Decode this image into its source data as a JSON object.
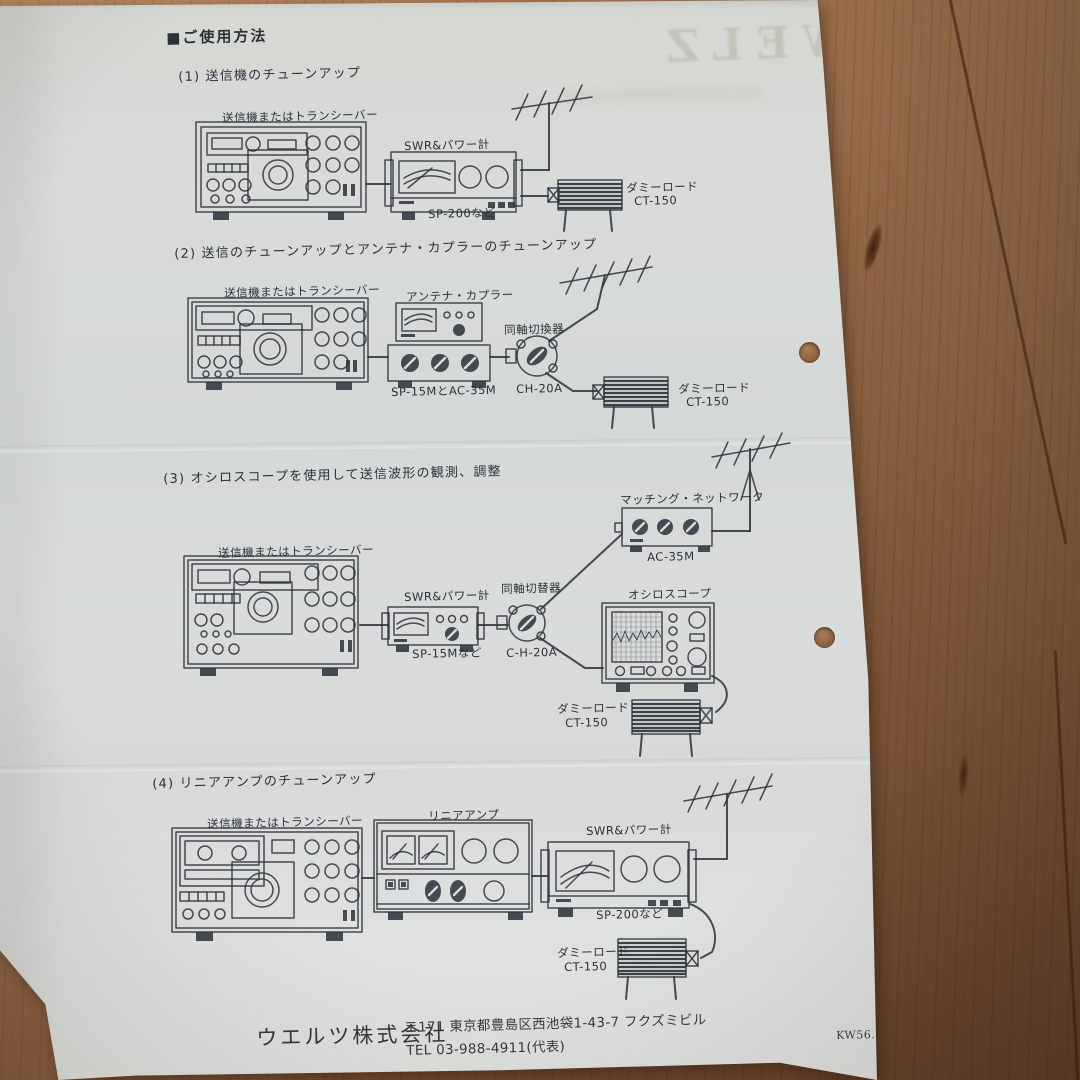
{
  "doc": {
    "title": "■ご使用方法",
    "sections": [
      {
        "heading": "(1) 送信機のチューンアップ",
        "labels": {
          "transceiver": "送信機またはトランシーバー",
          "meter": "SWR&パワー計",
          "meter_model": "SP-200など",
          "dummy": "ダミーロード",
          "dummy_model": "CT-150"
        }
      },
      {
        "heading": "(2) 送信のチューンアップとアンテナ・カプラーのチューンアップ",
        "labels": {
          "transceiver": "送信機またはトランシーバー",
          "coupler": "アンテナ・カプラー",
          "coupler_model": "SP-15MとAC-35M",
          "switch": "同軸切換器",
          "switch_model": "CH-20A",
          "dummy": "ダミーロード",
          "dummy_model": "CT-150"
        }
      },
      {
        "heading": "(3) オシロスコープを使用して送信波形の観測、調整",
        "labels": {
          "transceiver": "送信機またはトランシーバー",
          "matching": "マッチング・ネットワーク",
          "matching_model": "AC-35M",
          "meter": "SWR&パワー計",
          "meter_model": "SP-15Mなど",
          "switch": "同軸切替器",
          "switch_model": "C-H-20A",
          "scope": "オシロスコープ",
          "dummy": "ダミーロード",
          "dummy_model": "CT-150"
        }
      },
      {
        "heading": "(4) リニアアンプのチューンアップ",
        "labels": {
          "transceiver": "送信機またはトランシーバー",
          "amp": "リニアアンプ",
          "meter": "SWR&パワー計",
          "meter_model": "SP-200など",
          "dummy": "ダミーロード",
          "dummy_model": "CT-150"
        }
      }
    ],
    "footer": {
      "company": "ウエルツ株式会社",
      "address": "〒171 東京都豊島区西池袋1-43-7 フクズミビル",
      "tel": "TEL  03-988-4911(代表)",
      "code": "KW56.1"
    },
    "watermark": "WELZ",
    "colors": {
      "paper": "#d8dbd9",
      "wood": "#996b47",
      "ink": "#30363d"
    }
  }
}
